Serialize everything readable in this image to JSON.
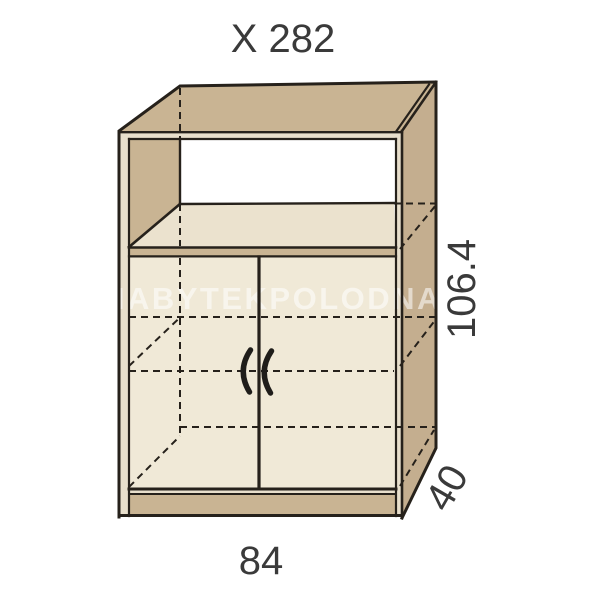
{
  "diagram": {
    "type": "furniture-technical-drawing",
    "product_label": "X 282",
    "dimensions": {
      "top_label": "X 282",
      "height": "106.4",
      "depth": "40",
      "width": "84"
    },
    "watermark": "NABYTEKPOLODNA",
    "parts": {
      "niche": "open shelf compartment",
      "doors": "two hinged doors with curved handles",
      "plinth": "base plinth"
    },
    "colors": {
      "panel_tan": "#c9b493",
      "panel_tan_dark": "#c4ae8f",
      "shelf_cream": "#ebe2ce",
      "door_cream": "#f0e9d7",
      "edge_cream": "#e8dfcc",
      "line_dark": "#26211b",
      "label_text": "#3a3a3a",
      "background": "#ffffff"
    }
  }
}
